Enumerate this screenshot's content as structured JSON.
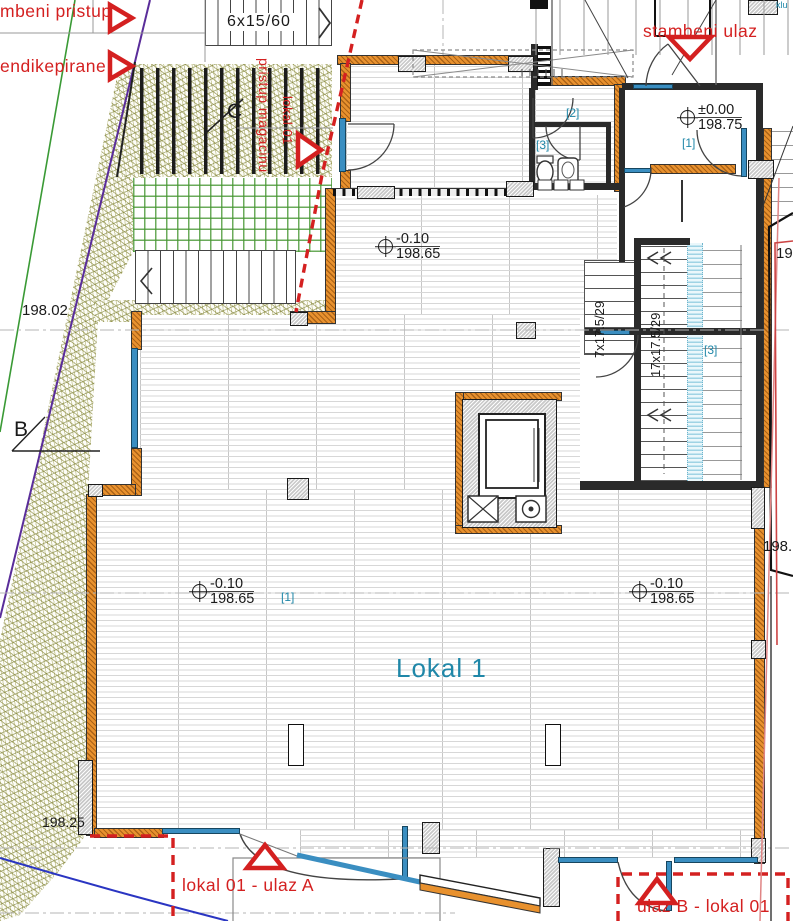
{
  "colors": {
    "label_red": "#d42020",
    "room_teal": "#1f87a8",
    "wall_orange": "#e8912e",
    "window_blue": "#3a8ec1",
    "veg_olive": "#7c7c28",
    "veg_green": "#469632",
    "glass_cyan": "#cdeaf4",
    "boundary_purple": "#5a2d9a",
    "boundary_green": "#3a9a35"
  },
  "site": {
    "access_cut": "mbeni pristup",
    "disabled_cut": "endikepirane",
    "stair_dim": "6x15/60",
    "spot_19802": "198.02",
    "spot_19825": "198.25",
    "section_b": "B",
    "section_c": "C"
  },
  "entrances": {
    "residential": "stambeni ulaz",
    "storage_access": "pristup magacinu",
    "lokal_vertical": "lokal 01",
    "ulaz_a": "lokal 01 - ulaz A",
    "ulaz_b": "ulaz B - lokal 01"
  },
  "rooms": {
    "main": "Lokal 1",
    "tag1": "[1]",
    "tag2": "[2]",
    "tag3": "[3]"
  },
  "levels": {
    "ground_top": "±0.00",
    "ground_val": "198.75",
    "lower_top": "-0.10",
    "lower_val": "198.65"
  },
  "stairs": {
    "side": "7x17.5/29",
    "main": "17x17.5/29"
  },
  "edge": {
    "cut_19": "19",
    "cut_198": "198.",
    "cut_klu": "klu"
  }
}
